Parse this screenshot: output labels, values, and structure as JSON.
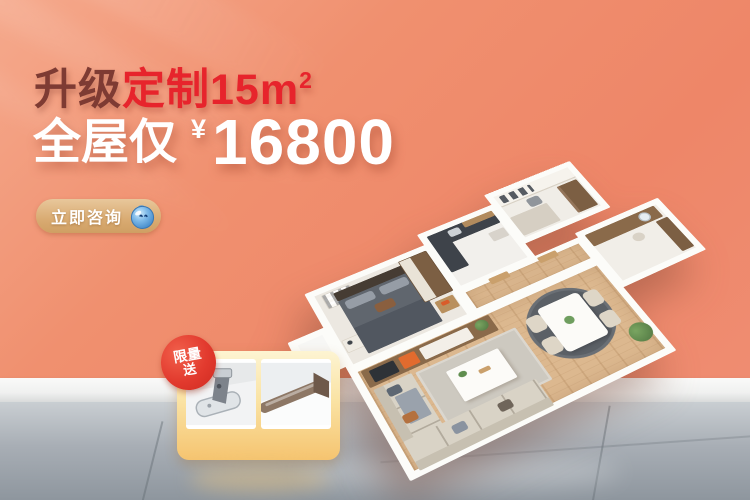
{
  "background": {
    "wall_color": "#ef8a6d",
    "baseboard_color": "#f2f3f2",
    "floor_color": "#9aa3ab"
  },
  "headline": {
    "part1": "升级",
    "part2": "定制15m",
    "sup": "2",
    "part1_color": "#7e3b33",
    "part2_color": "#e7242c"
  },
  "price": {
    "prefix": "全屋仅",
    "currency": "¥",
    "amount": "16800",
    "color": "#ffffff"
  },
  "cta": {
    "label": "立即咨询",
    "icon": "water-drop-mascot-icon",
    "bg_color": "#d9ab72",
    "text_color": "#ffffff"
  },
  "gift": {
    "badge_line1": "限量",
    "badge_line2": "送",
    "badge_color": "#e23a2e",
    "card_gradient": [
      "#fdf4d2",
      "#f5c470"
    ],
    "items": [
      {
        "icon": "cabinet-hinge-icon"
      },
      {
        "icon": "wardrobe-rail-icon"
      }
    ]
  },
  "floorplan": {
    "icon": "isometric-apartment-render",
    "accent_color": "#e26b2e",
    "wood_floor_color": "#dcb88f",
    "wall_color": "#fcfcf9"
  }
}
